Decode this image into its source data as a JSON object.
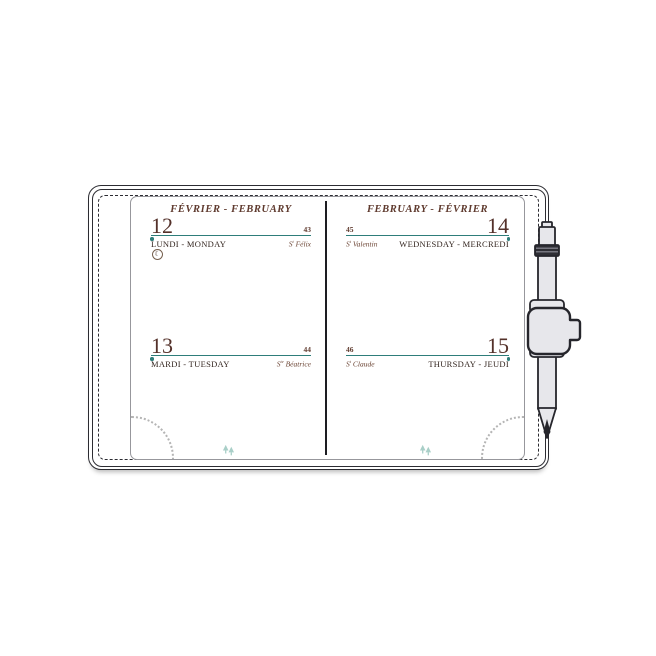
{
  "product": {
    "type": "weekly planner spread with pen"
  },
  "left_page": {
    "header": "FÉVRIER - FEBRUARY",
    "entries": [
      {
        "day": "12",
        "day_of_year": "43",
        "day_name": "LUNDI - MONDAY",
        "saint_prefix": "S",
        "saint_sup": "t",
        "saint_name": " Félix"
      },
      {
        "day": "13",
        "day_of_year": "44",
        "day_name": "MARDI - TUESDAY",
        "saint_prefix": "S",
        "saint_sup": "te",
        "saint_name": " Béatrice"
      }
    ]
  },
  "right_page": {
    "header": "FEBRUARY - FÉVRIER",
    "entries": [
      {
        "day": "14",
        "day_of_year": "45",
        "day_name": "WEDNESDAY - MERCREDI",
        "saint_prefix": "S",
        "saint_sup": "t",
        "saint_name": " Valentin"
      },
      {
        "day": "15",
        "day_of_year": "46",
        "day_name": "THURSDAY - JEUDI",
        "saint_prefix": "S",
        "saint_sup": "t",
        "saint_name": " Claude"
      }
    ]
  },
  "icons": {
    "moon_phase": "☾",
    "tree": "pine-trees",
    "pen": "pen-in-elastic-loop",
    "corner_arc": "dotted-quarter-circle"
  },
  "colors": {
    "accent_teal": "#2e7d7a",
    "header_brown": "#5f3a2e",
    "day_number_brown": "#54312a",
    "day_name_dark": "#33251f",
    "cover_outline": "#2c2c32",
    "page_border": "#97979c",
    "pen_fill": "#e7e7eb",
    "tree_teal": "#a9cfc8",
    "arc_gray": "#b5b5b5"
  }
}
